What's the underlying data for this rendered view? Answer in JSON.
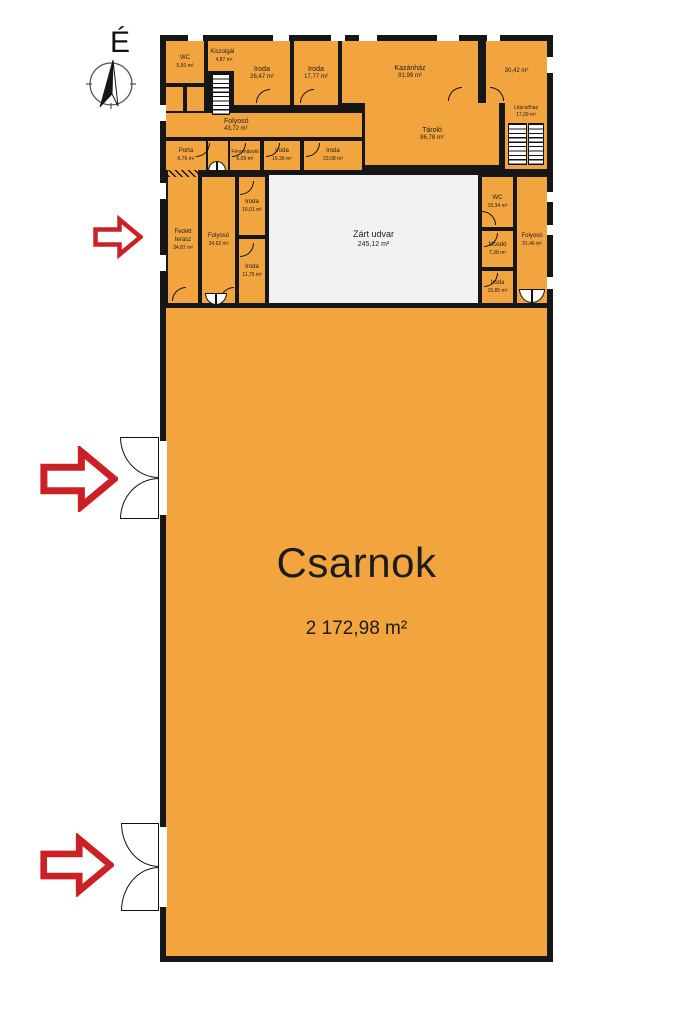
{
  "compass": {
    "label": "É"
  },
  "hall": {
    "name": "Csarnok",
    "area": "2 172,98 m²"
  },
  "rooms": {
    "wc_top": {
      "name": "WC",
      "area": "5,50 m²"
    },
    "kiszolgalo": {
      "name": "Kiszolgáló",
      "area": "4,87 m²"
    },
    "iroda_2647": {
      "name": "Iroda",
      "area": "26,47 m²"
    },
    "iroda_1777": {
      "name": "Iroda",
      "area": "17,77 m²"
    },
    "kazanhaz": {
      "name": "Kazánház",
      "area": "91,99 m²"
    },
    "room_3042": {
      "name": "",
      "area": "30,42 m²"
    },
    "lepcsohaz": {
      "name": "Lépcsőház",
      "area": "17,09 m²"
    },
    "folyoso_top": {
      "name": "Folyosó",
      "area": "43,72 m²"
    },
    "tarolo": {
      "name": "Tároló",
      "area": "86,78 m²"
    },
    "porta": {
      "name": "Porta",
      "area": "6,76 m²"
    },
    "fenymasolo": {
      "name": "Fénymásoló",
      "area": "6,09 m²"
    },
    "iroda_1636": {
      "name": "Iroda",
      "area": "16,36 m²"
    },
    "iroda_2308": {
      "name": "Iroda",
      "area": "23,08 m²"
    },
    "fedett_terasz": {
      "name": "Fedett terasz",
      "area": "34,87 m²"
    },
    "folyoso_mid": {
      "name": "Folyosó",
      "area": "34,62 m²"
    },
    "iroda_1601": {
      "name": "Iroda",
      "area": "16,01 m²"
    },
    "iroda_1175": {
      "name": "Iroda",
      "area": "11,75 m²"
    },
    "zart_udvar": {
      "name": "Zárt udvar",
      "area": "245,12 m²"
    },
    "wc_mid": {
      "name": "WC",
      "area": "15,34 m²"
    },
    "folyoso_right": {
      "name": "Folyosó",
      "area": "31,46 m²"
    },
    "mosdo": {
      "name": "Mosdó",
      "area": "7,38 m²"
    },
    "iroda_1585": {
      "name": "Iroda",
      "area": "15,85 m²"
    }
  },
  "colors": {
    "room_fill": "#F2A43E",
    "wall": "#161616",
    "courtyard": "#F1F1F0",
    "arrow_red": "#CB2026"
  }
}
